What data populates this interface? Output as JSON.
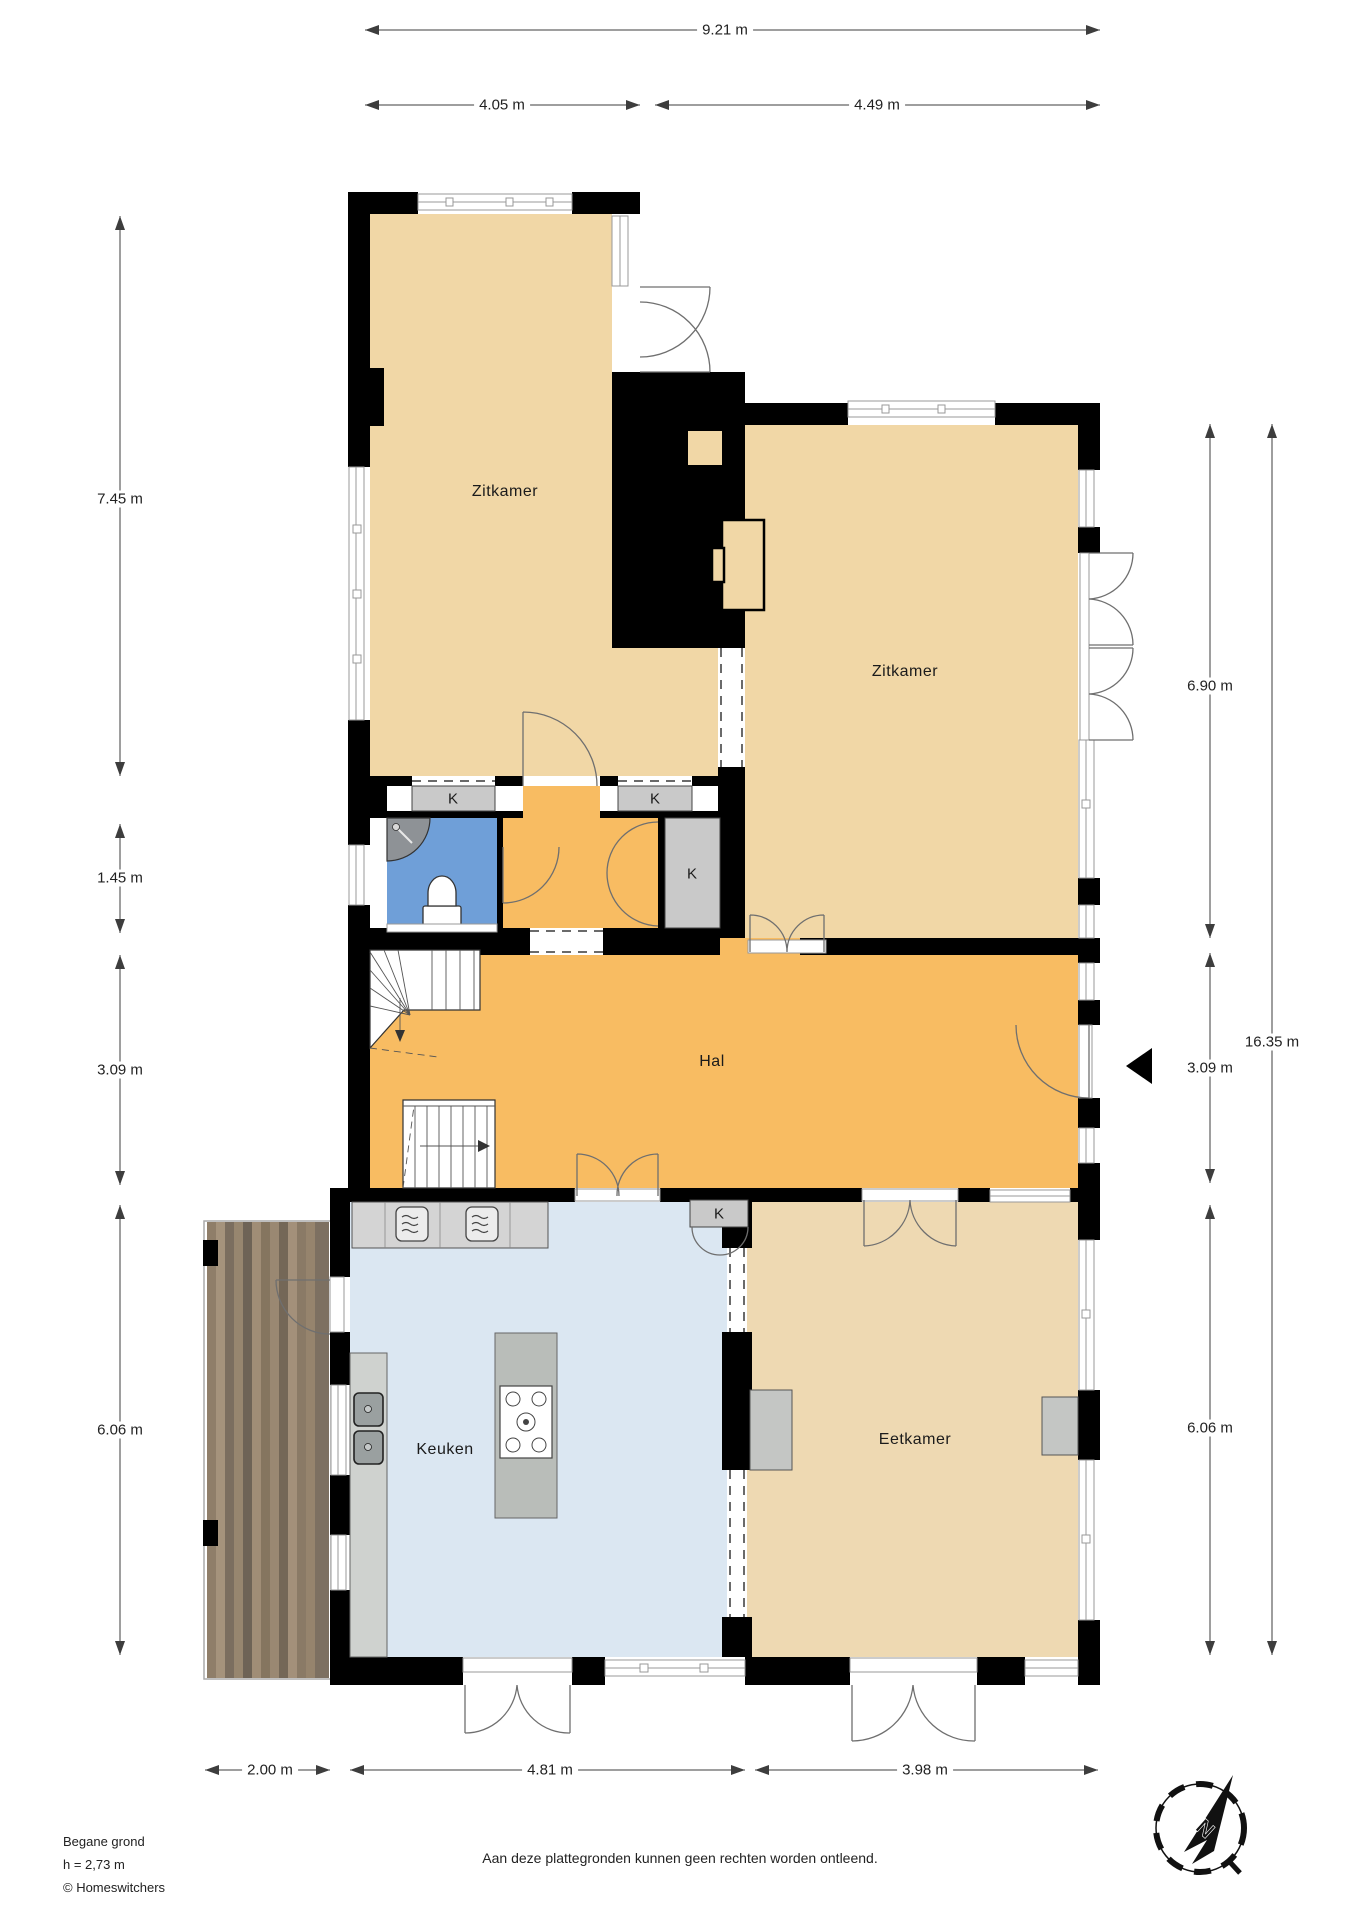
{
  "title": "Begane grond plattegrond",
  "rooms": {
    "zitkamer_left": {
      "label": "Zitkamer"
    },
    "zitkamer_right": {
      "label": "Zitkamer"
    },
    "hal": {
      "label": "Hal"
    },
    "keuken": {
      "label": "Keuken"
    },
    "eetkamer": {
      "label": "Eetkamer"
    }
  },
  "closet_label": "K",
  "dimensions": {
    "top_total": "9.21 m",
    "top_left": "4.05 m",
    "top_right": "4.49 m",
    "left_zitkamer": "7.45 m",
    "left_strip": "1.45 m",
    "left_hal": "3.09 m",
    "left_keuken": "6.06 m",
    "right_zitkamer": "6.90 m",
    "right_hal": "3.09 m",
    "right_eetkamer": "6.06 m",
    "right_total": "16.35 m",
    "bottom_terras": "2.00 m",
    "bottom_keuken": "4.81 m",
    "bottom_eetkamer": "3.98 m"
  },
  "footer": {
    "floor_name": "Begane grond",
    "ceiling_height": "h = 2,73 m",
    "copyright": "© Homeswitchers",
    "disclaimer": "Aan deze plattegronden kunnen geen rechten worden ontleend."
  },
  "compass": {
    "north_label": "N"
  },
  "colors": {
    "room_tan": "#f1d7a6",
    "room_tan_light": "#eed9b2",
    "hal_orange": "#f8bc62",
    "bathroom_blue": "#6f9fd8",
    "kitchen_blue": "#dbe7f2",
    "closet_gray": "#c9c9c9",
    "wall_black": "#000000"
  }
}
